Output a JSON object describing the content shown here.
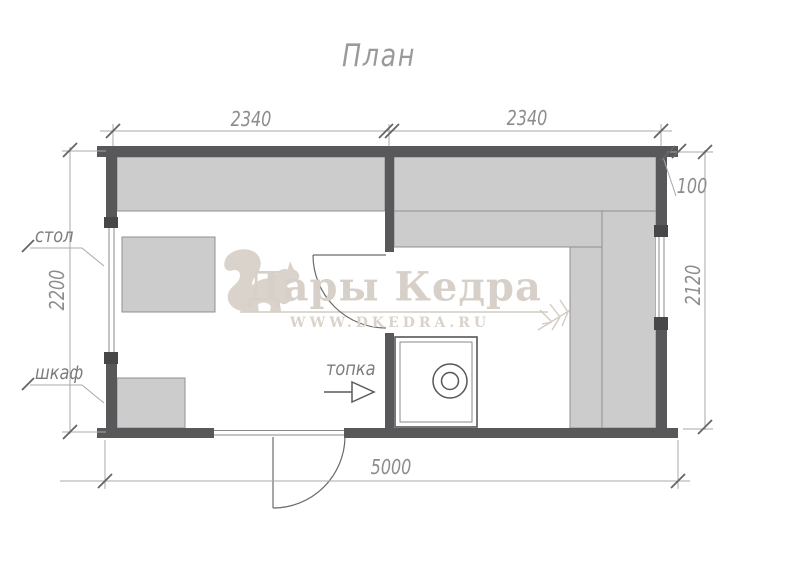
{
  "title": "План",
  "dimensions": {
    "top_left_room_width": "2340",
    "top_right_room_width": "2340",
    "roof_overhang": "100",
    "right_room_depth": "2120",
    "left_room_depth": "2200",
    "total_length": "5000"
  },
  "labels": {
    "table": "стол",
    "cabinet": "шкаф",
    "furnace": "топка"
  },
  "watermark": {
    "brand": "Дары Кедра",
    "website": "WWW.DKEDRA.RU"
  },
  "colors": {
    "wall": "#58585a",
    "bench_fill": "#cbcccb",
    "dimension_line": "#a8a8a8",
    "dimension_text": "#8c8c8c",
    "watermark": "#d6d0c8"
  }
}
